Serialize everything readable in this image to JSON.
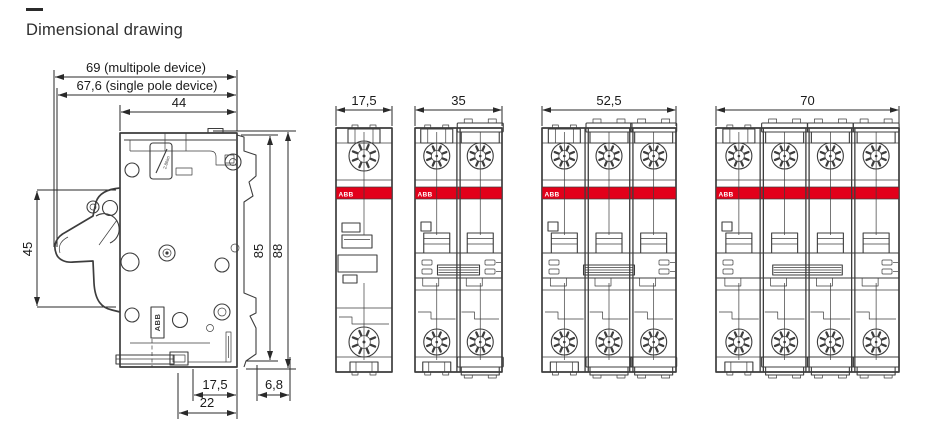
{
  "page": {
    "title": "Dimensional drawing"
  },
  "colors": {
    "abb_red": "#e2001a",
    "line": "#3d3d3d",
    "text": "#1a1a1a",
    "background": "#ffffff"
  },
  "side_view": {
    "description": "side profile of miniature circuit breaker",
    "dims": {
      "multipole": "69 (multipole device)",
      "singlepole": "67,6 (single pole device)",
      "front_width": "44",
      "front_height": "45",
      "body_height": "85",
      "total_height": "88",
      "din_width": "17,5",
      "base_width": "22",
      "rear_depth": "6,8"
    },
    "brand": "ABB",
    "torque": "2.8Nm"
  },
  "front_views": [
    {
      "id": "single-pole",
      "poles": 1,
      "width_label": "17,5",
      "brand": "ABB"
    },
    {
      "id": "two-pole",
      "poles": 2,
      "width_label": "35",
      "brand": "ABB"
    },
    {
      "id": "three-pole",
      "poles": 3,
      "width_label": "52,5",
      "brand": "ABB"
    },
    {
      "id": "four-pole",
      "poles": 4,
      "width_label": "70",
      "brand": "ABB"
    }
  ]
}
